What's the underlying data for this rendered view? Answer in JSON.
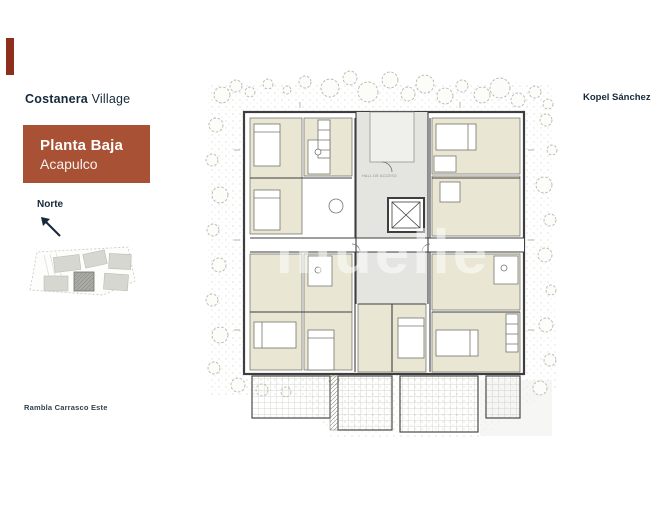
{
  "brand": {
    "bold": "Costanera",
    "light": "Village"
  },
  "title_card": {
    "title": "Planta Baja",
    "subtitle": "Acapulco"
  },
  "north_label": "Norte",
  "architect": "Kopel Sánchez",
  "street": "Rambla Carrasco Este",
  "watermark": "muelle",
  "plan_labels": {
    "hall": "HALL DE ACCESO"
  },
  "colors": {
    "accent": "#a85135",
    "brand-mark": "#8e2f1d",
    "ink": "#16283a",
    "street-ink": "#32424d",
    "room": "#eae6d4",
    "wall": "#3e3e3e",
    "hall": "#e4e4e1",
    "veg": "#b7b7b1"
  }
}
